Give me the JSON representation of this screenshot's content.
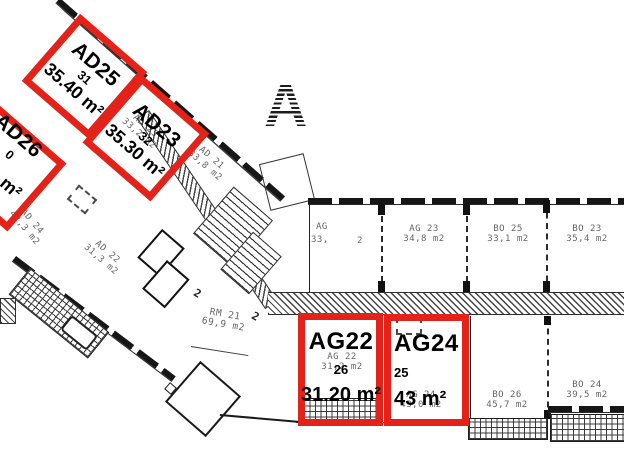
{
  "meta": {
    "kind": "apartment floor plan with highlighted units",
    "section_marker": "A"
  },
  "colors": {
    "highlight_red": "#e3231a",
    "plan_line": "#1b1b1b",
    "faded_text": "#3d3d3d",
    "background": "#ffffff"
  },
  "units": {
    "ad25": {
      "code": "AD25",
      "number": "31",
      "area": "35.40 m²"
    },
    "ad23": {
      "code": "AD23",
      "number": "32",
      "area": "35.30 m²"
    },
    "ad26": {
      "code": "AD26",
      "number_visible": "0",
      "area_visible": "m²"
    },
    "ag22": {
      "code": "AG22",
      "number": "26",
      "area": "31.20 m²"
    },
    "ag24": {
      "code": "AG24",
      "number": "25",
      "area": "43 m²"
    }
  },
  "plan_labels": {
    "ad21": {
      "code": "AD 21",
      "area": "33,8 m2"
    },
    "ad24": {
      "code": "AD 24",
      "area": "42,3 m2"
    },
    "ad22": {
      "code": "AD 22",
      "area": "31,3 m2"
    },
    "ad23_orig": {
      "code": "AD 23",
      "area": "33,2 m2"
    },
    "rm21": {
      "code": "RM 21",
      "area": "69,9 m2"
    },
    "ag21": {
      "code": "AG",
      "area": "33,",
      "area_tail": "2"
    },
    "ag23": {
      "code": "AG 23",
      "area": "34,8 m2"
    },
    "bo25": {
      "code": "BO 25",
      "area": "33,1 m2"
    },
    "bo23": {
      "code": "BO 23",
      "area": "35,4 m2"
    },
    "bo26": {
      "code": "BO 26",
      "area": "45,7 m2"
    },
    "bo24": {
      "code": "BO 24",
      "area": "39,5 m2"
    },
    "ag22_orig": {
      "code": "AG 22",
      "area": "31,2 m2"
    },
    "ag24_orig": {
      "code": "AG 24",
      "area": "43,0 m2"
    }
  },
  "annotations": {
    "dim1": "2",
    "dim2": "2"
  }
}
